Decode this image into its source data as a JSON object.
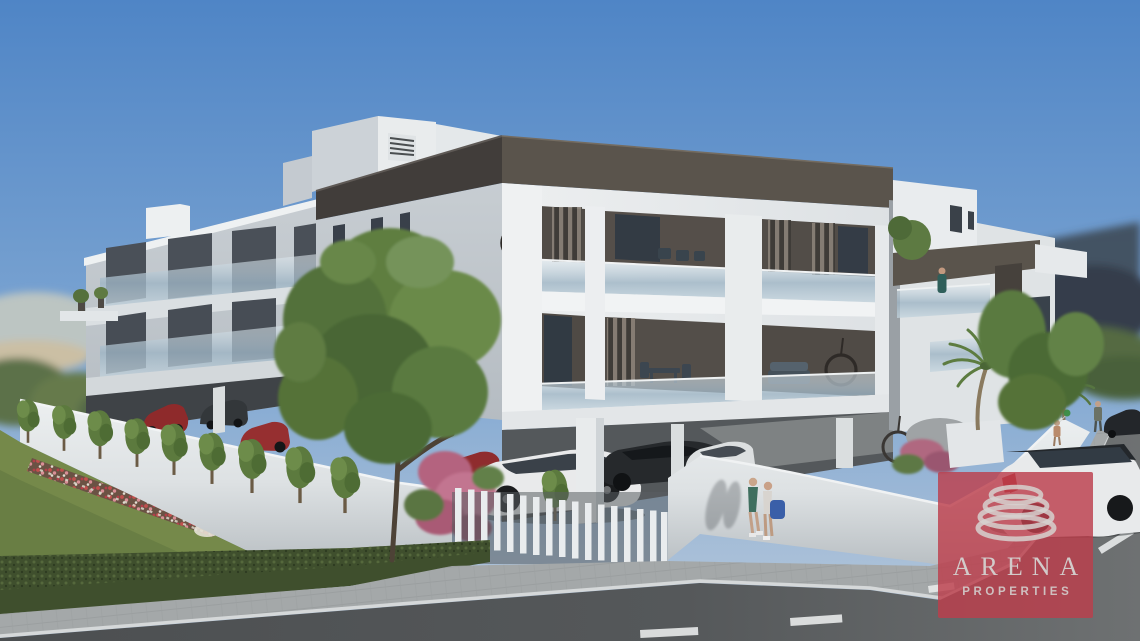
{
  "image": {
    "kind": "architectural-3d-render",
    "subject": "Modern two-storey white apartment building with open carport parking, corner street view on a sunny day"
  },
  "watermark": {
    "brand": "ARENA",
    "tagline": "PROPERTIES",
    "icon": "coil-rings-icon"
  },
  "colors": {
    "sky-top": "#4f85c6",
    "sky-mid": "#7ea6d2",
    "sky-horizon": "#b9c9da",
    "facade-lit": "#edeff0",
    "facade-shade": "#c7cdd2",
    "fascia-dark": "#413d3a",
    "fascia-mid": "#5a544c",
    "glass-dark": "#39424c",
    "railing-glass": "#9db4c4",
    "grass": "#75894a",
    "grass-dark": "#5f7540",
    "hedge": "#3f4f2d",
    "road": "#55585a",
    "sidewalk": "#a4a8a9",
    "wall-white": "#dde1e3",
    "brand-red-rgba": "rgba(188,62,76,0.82)",
    "logo-text": "#d2cbca"
  },
  "scene": {
    "building": {
      "floors_visible": 2,
      "ground_level": "open carport parking on white columns",
      "features": [
        "dark roof fascia bands",
        "frosted glass balcony railings",
        "vertical timber slat screens",
        "hanging egg chairs",
        "roof terraces with potted plants"
      ]
    },
    "vehicles": [
      {
        "type": "suv",
        "color": "white with black roof",
        "location": "street corner, foreground right"
      },
      {
        "type": "suv",
        "color": "white",
        "location": "carport center"
      },
      {
        "type": "sedan",
        "color": "dark grey",
        "location": "carport"
      },
      {
        "type": "sedan",
        "color": "white",
        "location": "carport right"
      },
      {
        "type": "hatchback",
        "color": "red",
        "location": "carport left"
      },
      {
        "type": "sedan",
        "color": "red",
        "location": "carport left"
      },
      {
        "type": "car",
        "color": "dark",
        "location": "side street, parked"
      }
    ],
    "people": [
      {
        "label": "couple-walking",
        "detail": "two pedestrians with a blue bag on the sidewalk"
      },
      {
        "label": "man-walking",
        "detail": "man on the side street"
      },
      {
        "label": "child-with-balloons",
        "detail": "balloons red, blue and green"
      },
      {
        "label": "balcony-person",
        "detail": "person standing on first-floor balcony"
      }
    ],
    "landscape": [
      "front lawn",
      "diagonal red-white flower bed",
      "trimmed hedge along sidewalk",
      "row of young trees",
      "pink bougainvillea",
      "palm trees",
      "white boundary wall",
      "white slat fence"
    ],
    "streets": [
      "main road with dashed center line, foreground",
      "side street receding to the right"
    ]
  }
}
